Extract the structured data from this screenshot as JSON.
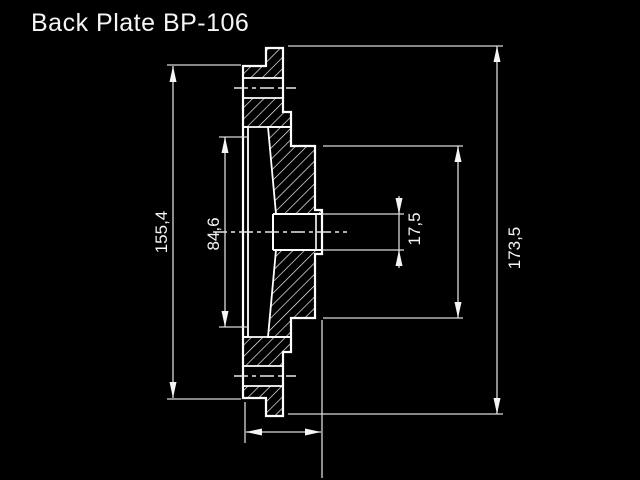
{
  "title": "Back Plate BP-106",
  "colors": {
    "background": "#000000",
    "part_lines": "#ffffff",
    "dimension_lines": "#d9d9d9",
    "text": "#f5f5f5"
  },
  "drawing": {
    "part_name": "Back Plate",
    "part_number": "BP-106",
    "view": "cross-section",
    "dimensions": {
      "outer_face_diameter": {
        "value": "155,4"
      },
      "inner_step_diameter": {
        "value": "84,6"
      },
      "bore_diameter": {
        "value": "17,5"
      },
      "overall_diameter": {
        "value": "173,5"
      }
    }
  }
}
